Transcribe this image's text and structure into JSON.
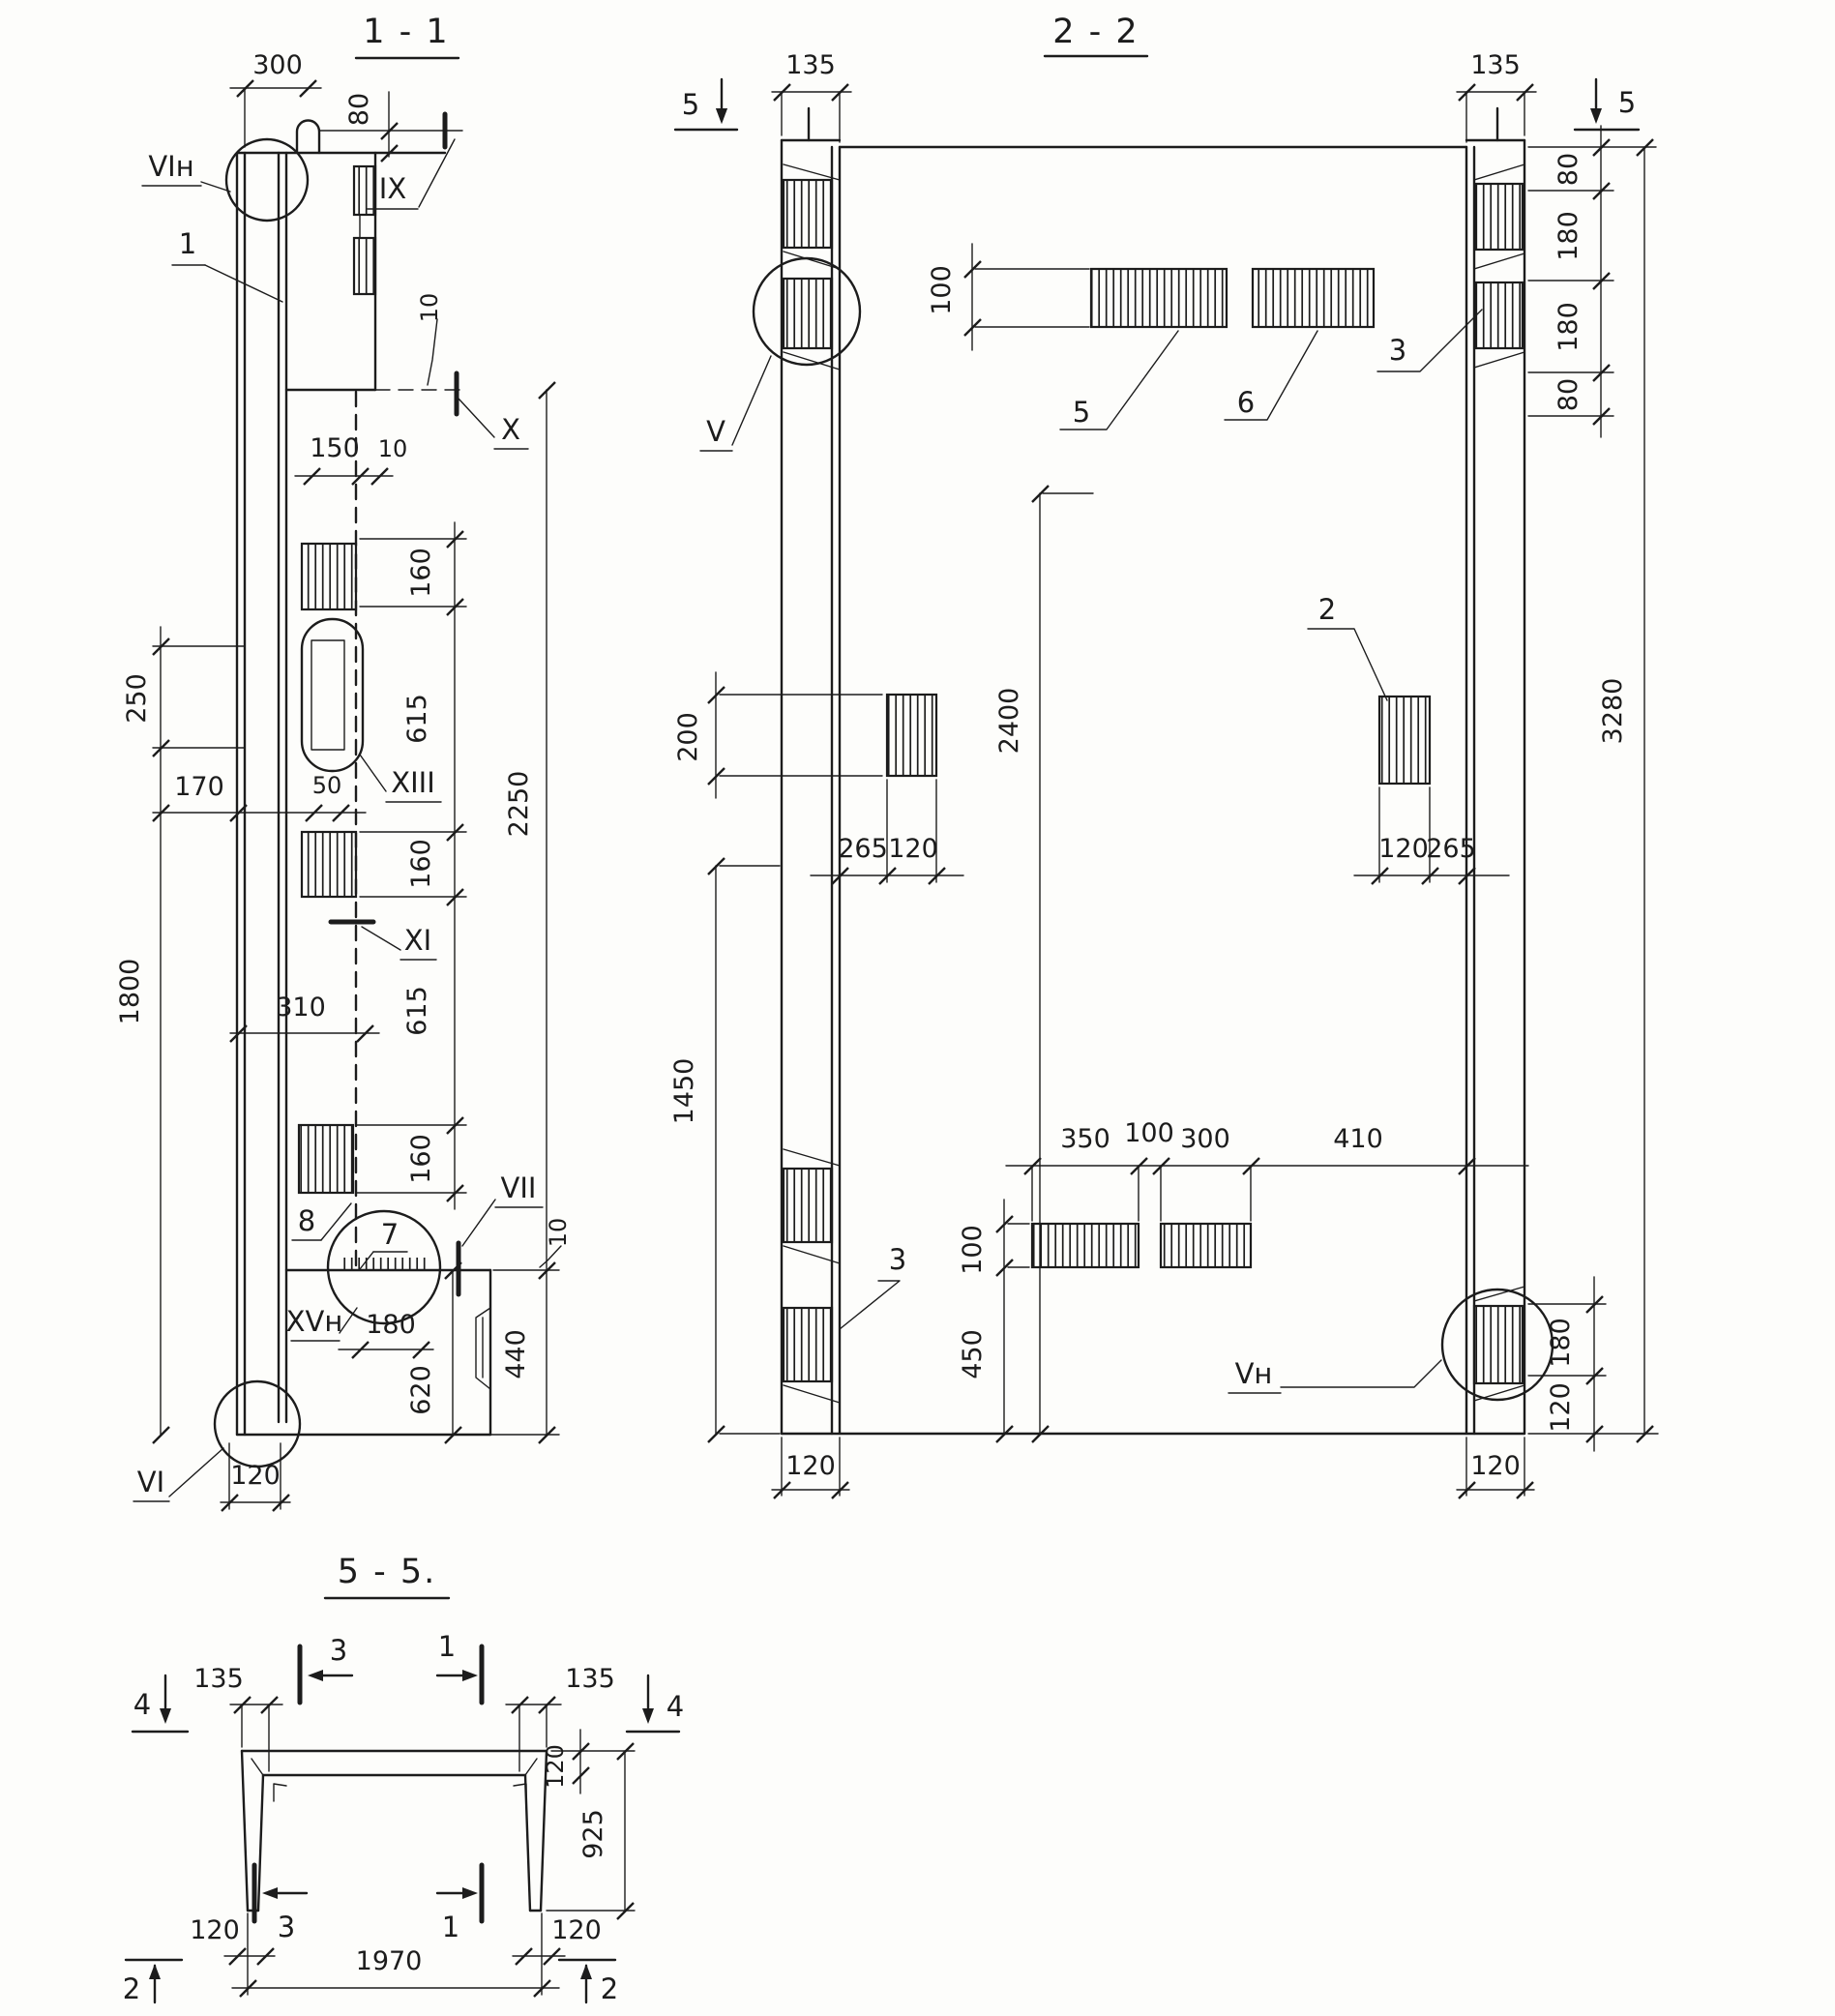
{
  "style": {
    "ink": "#1c1c1c",
    "paper": "#fdfdfb"
  },
  "drawing": {
    "s11": {
      "title": "1 - 1",
      "dims": {
        "w300": "300",
        "h80": "80",
        "g10top": "10",
        "w150": "150",
        "g10mid": "10",
        "c160a": "160",
        "c615a": "615",
        "c160b": "160",
        "c615b": "615",
        "c160c": "160",
        "h2250": "2250",
        "h250": "250",
        "w170": "170",
        "w50": "50",
        "h1800": "1800",
        "w310": "310",
        "w180": "180",
        "h620": "620",
        "h440": "440",
        "g10low": "10",
        "w120": "120"
      },
      "callouts": {
        "vin": "VIн",
        "pos1": "1",
        "ix": "IX",
        "x": "X",
        "xiii": "XIII",
        "xi": "XI",
        "pos8": "8",
        "pos7": "7",
        "vii": "VII",
        "xvn": "XVн",
        "vi": "VI"
      }
    },
    "s22": {
      "title": "2 - 2",
      "dims": {
        "w135L": "135",
        "w135R": "135",
        "h100top": "100",
        "c80a": "80",
        "c180a": "180",
        "c180b": "180",
        "c80b": "80",
        "h3280": "3280",
        "h200": "200",
        "w265L": "265",
        "w120L": "120",
        "w120R": "120",
        "w265R": "265",
        "h2400": "2400",
        "h1450": "1450",
        "h100bot": "100",
        "h450": "450",
        "w350": "350",
        "w100": "100",
        "w300": "300",
        "w410": "410",
        "c180r": "180",
        "c120r": "120",
        "w120botL": "120",
        "w120botR": "120"
      },
      "callouts": {
        "v": "V",
        "vn": "Vн",
        "pos2": "2",
        "pos3top": "3",
        "pos3bot": "3",
        "pos5": "5",
        "pos6": "6"
      },
      "cuts": {
        "m5L": "5",
        "m5R": "5"
      }
    },
    "s55": {
      "title": "5 - 5.",
      "dims": {
        "w135L": "135",
        "w135R": "135",
        "t120web": "120",
        "h925": "925",
        "w120botL": "120",
        "w120botR": "120",
        "w1970": "1970"
      },
      "cuts": {
        "m4L": "4",
        "m4R": "4",
        "m3top": "3",
        "m1top": "1",
        "m3bot": "3",
        "m1bot": "1",
        "m2L": "2",
        "m2R": "2"
      }
    }
  }
}
